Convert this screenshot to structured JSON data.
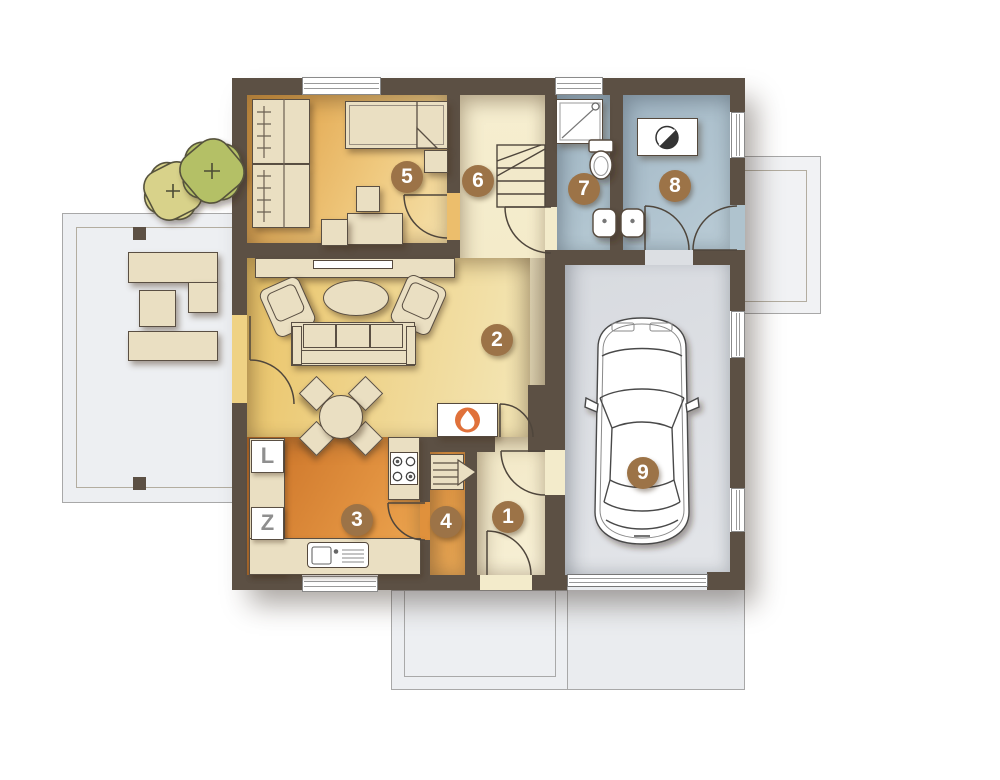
{
  "rooms": [
    {
      "number": "1"
    },
    {
      "number": "2"
    },
    {
      "number": "3"
    },
    {
      "number": "4"
    },
    {
      "number": "5"
    },
    {
      "number": "6"
    },
    {
      "number": "7"
    },
    {
      "number": "8"
    },
    {
      "number": "9"
    }
  ],
  "labels": {
    "fridge": "L",
    "dishwasher": "Z"
  },
  "icons": {
    "tree_mark": "+",
    "fireplace_flame": "flame",
    "boiler_dial": "half-disc"
  },
  "colors": {
    "wall": "#5C5044",
    "room_badge": "#9C7347",
    "bedroom_floor": "#E0A148",
    "living_floor": "#EAC468",
    "kitchen_floor": "#D8842F",
    "hall_floor": "#F3EBCA",
    "bath_floor": "#ABBFCB",
    "garage_floor": "#DCDFE3",
    "terrace": "#EDEFF2",
    "tree_light": "#D8D28A",
    "tree_dark": "#B4C066",
    "fireplace_accent": "#E0713A",
    "furniture": "#EADFC2"
  }
}
